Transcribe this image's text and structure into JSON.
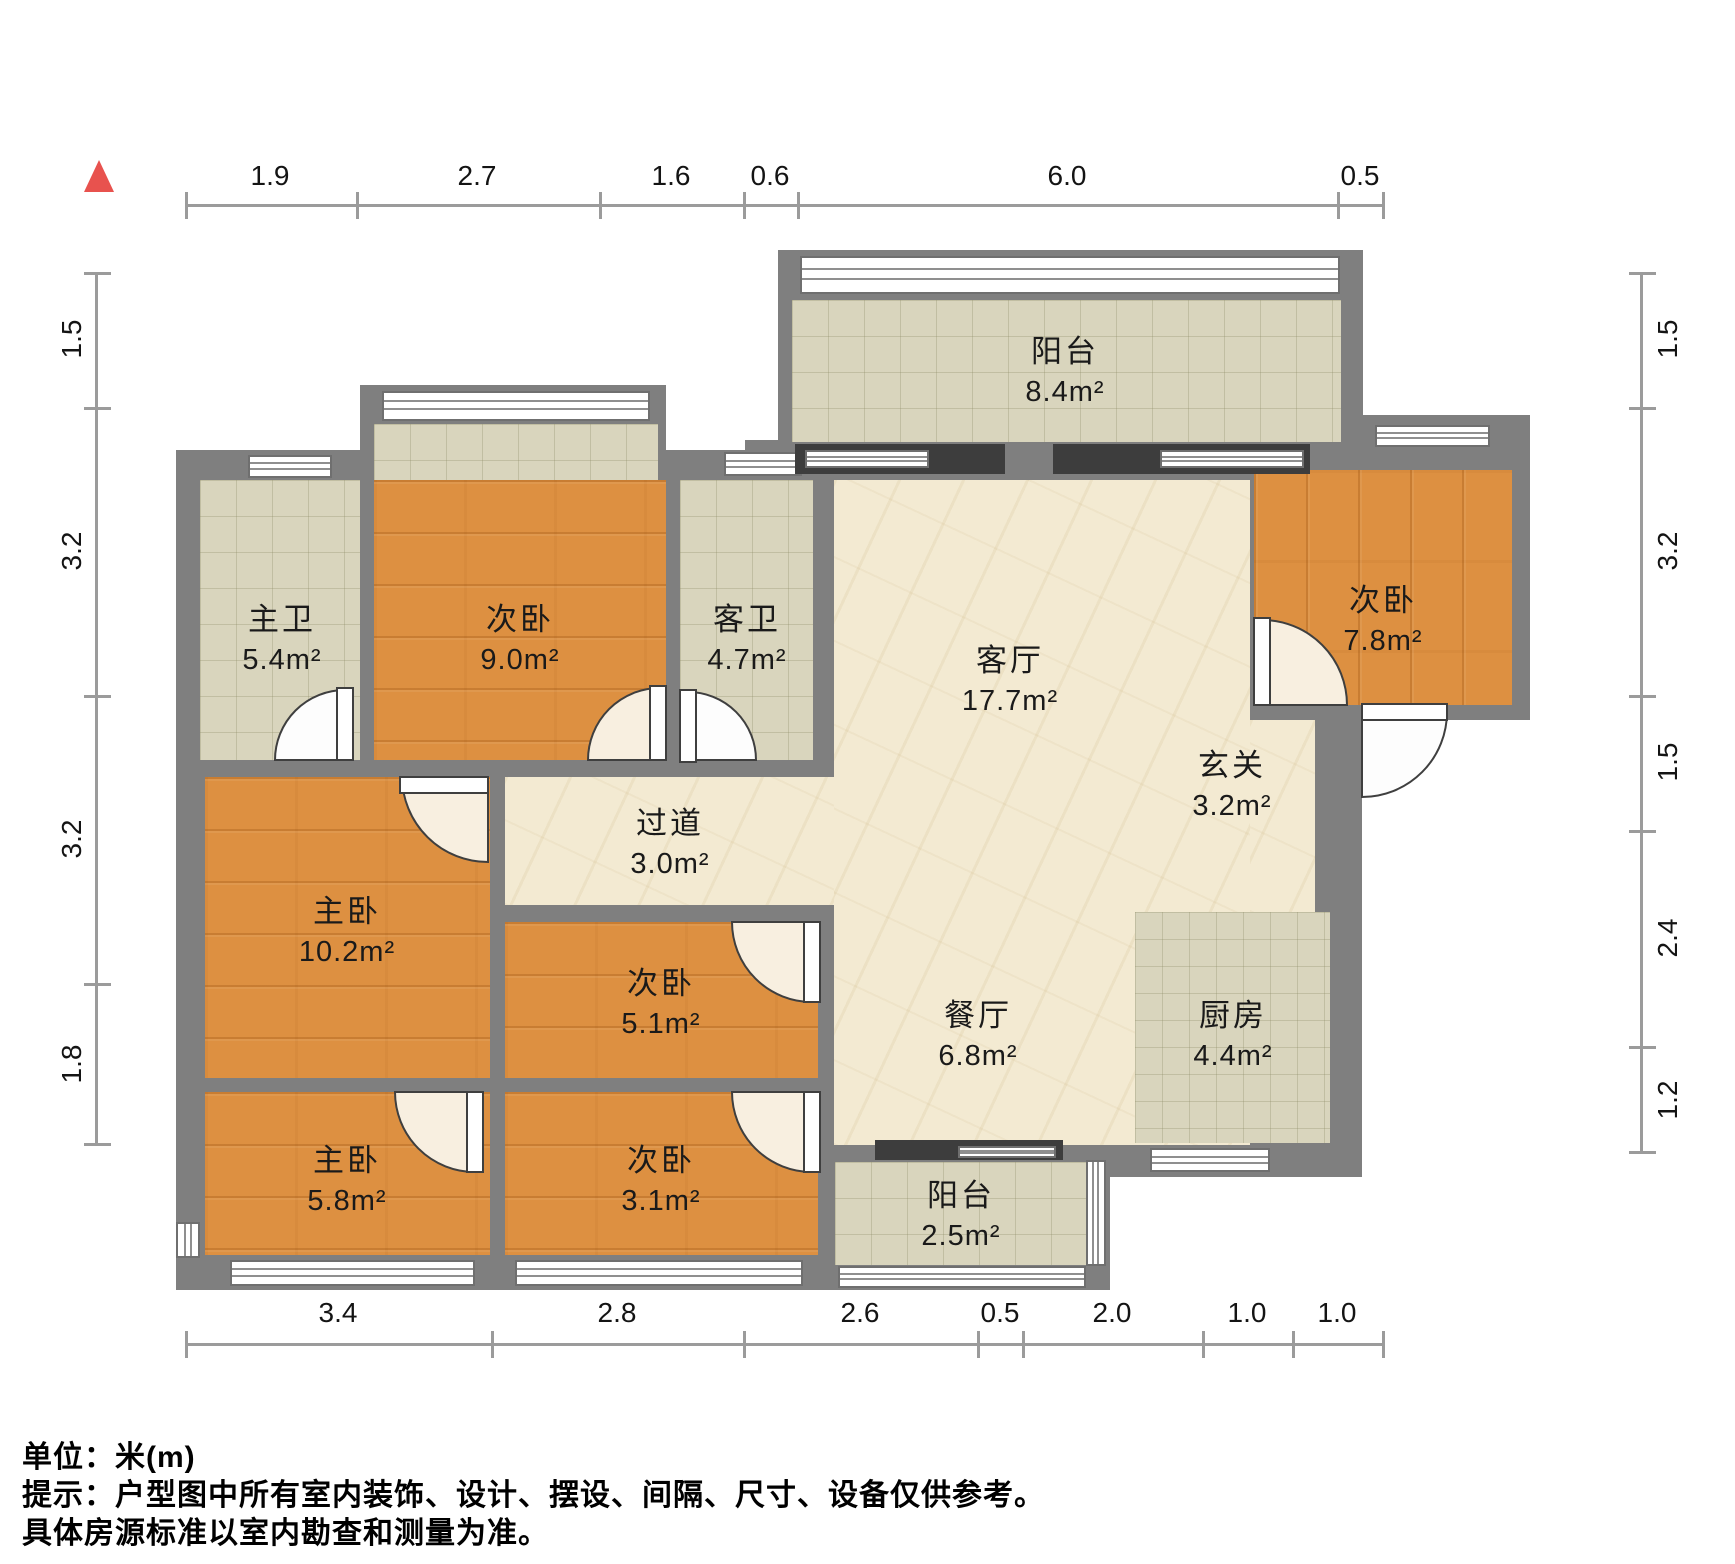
{
  "compass": {
    "shape": "north-triangle",
    "color": "#e8524e"
  },
  "dimensions": {
    "unit": "m",
    "top": [
      "1.9",
      "2.7",
      "1.6",
      "0.6",
      "6.0",
      "0.5"
    ],
    "bottom": [
      "3.4",
      "2.8",
      "2.6",
      "0.5",
      "2.0",
      "1.0",
      "1.0"
    ],
    "left": [
      "1.5",
      "3.2",
      "3.2",
      "1.8"
    ],
    "right": [
      "1.5",
      "3.2",
      "1.5",
      "2.4",
      "1.2"
    ]
  },
  "rooms": [
    {
      "name": "阳台",
      "area": "8.4m²",
      "type": "balcony"
    },
    {
      "name": "主卫",
      "area": "5.4m²",
      "type": "bathroom"
    },
    {
      "name": "次卧",
      "area": "9.0m²",
      "type": "bedroom"
    },
    {
      "name": "客卫",
      "area": "4.7m²",
      "type": "bathroom"
    },
    {
      "name": "客厅",
      "area": "17.7m²",
      "type": "living-room"
    },
    {
      "name": "次卧",
      "area": "7.8m²",
      "type": "bedroom"
    },
    {
      "name": "过道",
      "area": "3.0m²",
      "type": "corridor"
    },
    {
      "name": "玄关",
      "area": "3.2m²",
      "type": "entry-hall"
    },
    {
      "name": "主卧",
      "area": "10.2m²",
      "type": "master-bedroom"
    },
    {
      "name": "次卧",
      "area": "5.1m²",
      "type": "bedroom"
    },
    {
      "name": "餐厅",
      "area": "6.8m²",
      "type": "dining-room"
    },
    {
      "name": "厨房",
      "area": "4.4m²",
      "type": "kitchen"
    },
    {
      "name": "主卧",
      "area": "5.8m²",
      "type": "master-bedroom"
    },
    {
      "name": "次卧",
      "area": "3.1m²",
      "type": "bedroom"
    },
    {
      "name": "阳台",
      "area": "2.5m²",
      "type": "balcony"
    }
  ],
  "footer": {
    "unit_note": "单位：米(m)",
    "disclaimer_line1": "提示：户型图中所有室内装饰、设计、摆设、间隔、尺寸、设备仅供参考。",
    "disclaimer_line2": "具体房源标准以室内勘查和测量为准。"
  },
  "colors": {
    "wall": "#7f7f7f",
    "dark_frame": "#3d3d3d",
    "tile_floor": "#d9d5bd",
    "wood_floor": "#dd9041",
    "marble_floor": "#f3ead2",
    "dimension_line": "#9b9b9b",
    "north_marker": "#e8524e"
  }
}
